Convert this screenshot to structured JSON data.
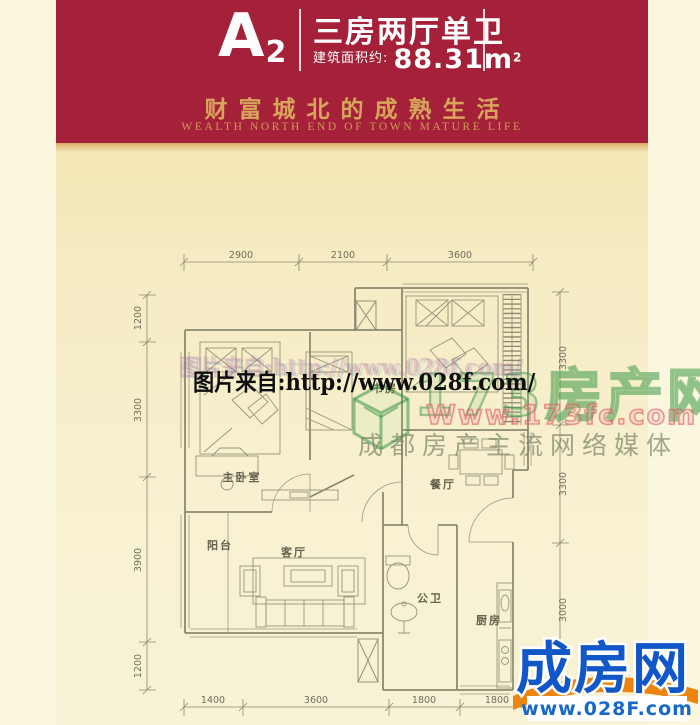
{
  "banner": {
    "unit_main": "A",
    "unit_sub": "2",
    "layout_title": "三房两厅单卫",
    "area_label": "建筑面积约:",
    "area_value": "88.31m",
    "area_unit_sup": "2",
    "slogan_cn": "财富城北的成熟生活",
    "slogan_en": "WEALTH NORTH END OF TOWN MATURE LIFE"
  },
  "floor_plan": {
    "rooms": {
      "master": "主卧室",
      "study": "书房",
      "dining": "餐厅",
      "balcony": "阳台",
      "living": "客厅",
      "bath": "公卫",
      "kitchen": "厨房"
    },
    "dims": {
      "top": [
        "2900",
        "2100",
        "3600"
      ],
      "left": [
        "1200",
        "3300",
        "3900",
        "1200"
      ],
      "right": [
        "3300",
        "3300",
        "3000"
      ],
      "bottom": [
        "1400",
        "3600",
        "1800",
        "1800"
      ]
    }
  },
  "watermarks": {
    "photo_source": "图片来自:http://www.028f.com/",
    "portal_name": "173房产网",
    "portal_url": "Www.173fc.com",
    "portal_slogan": "成都房产主流网络媒体"
  },
  "footer_logo": {
    "name": "成房网",
    "url": "www.028F.com"
  },
  "colors": {
    "banner_red": "#A52139",
    "banner_gold": "#D8A55C",
    "logo_blue": "#1257C8",
    "logo_orange": "#EC8412",
    "watermark_green": "#38963F",
    "paper_cream": "#F8F1D2"
  }
}
